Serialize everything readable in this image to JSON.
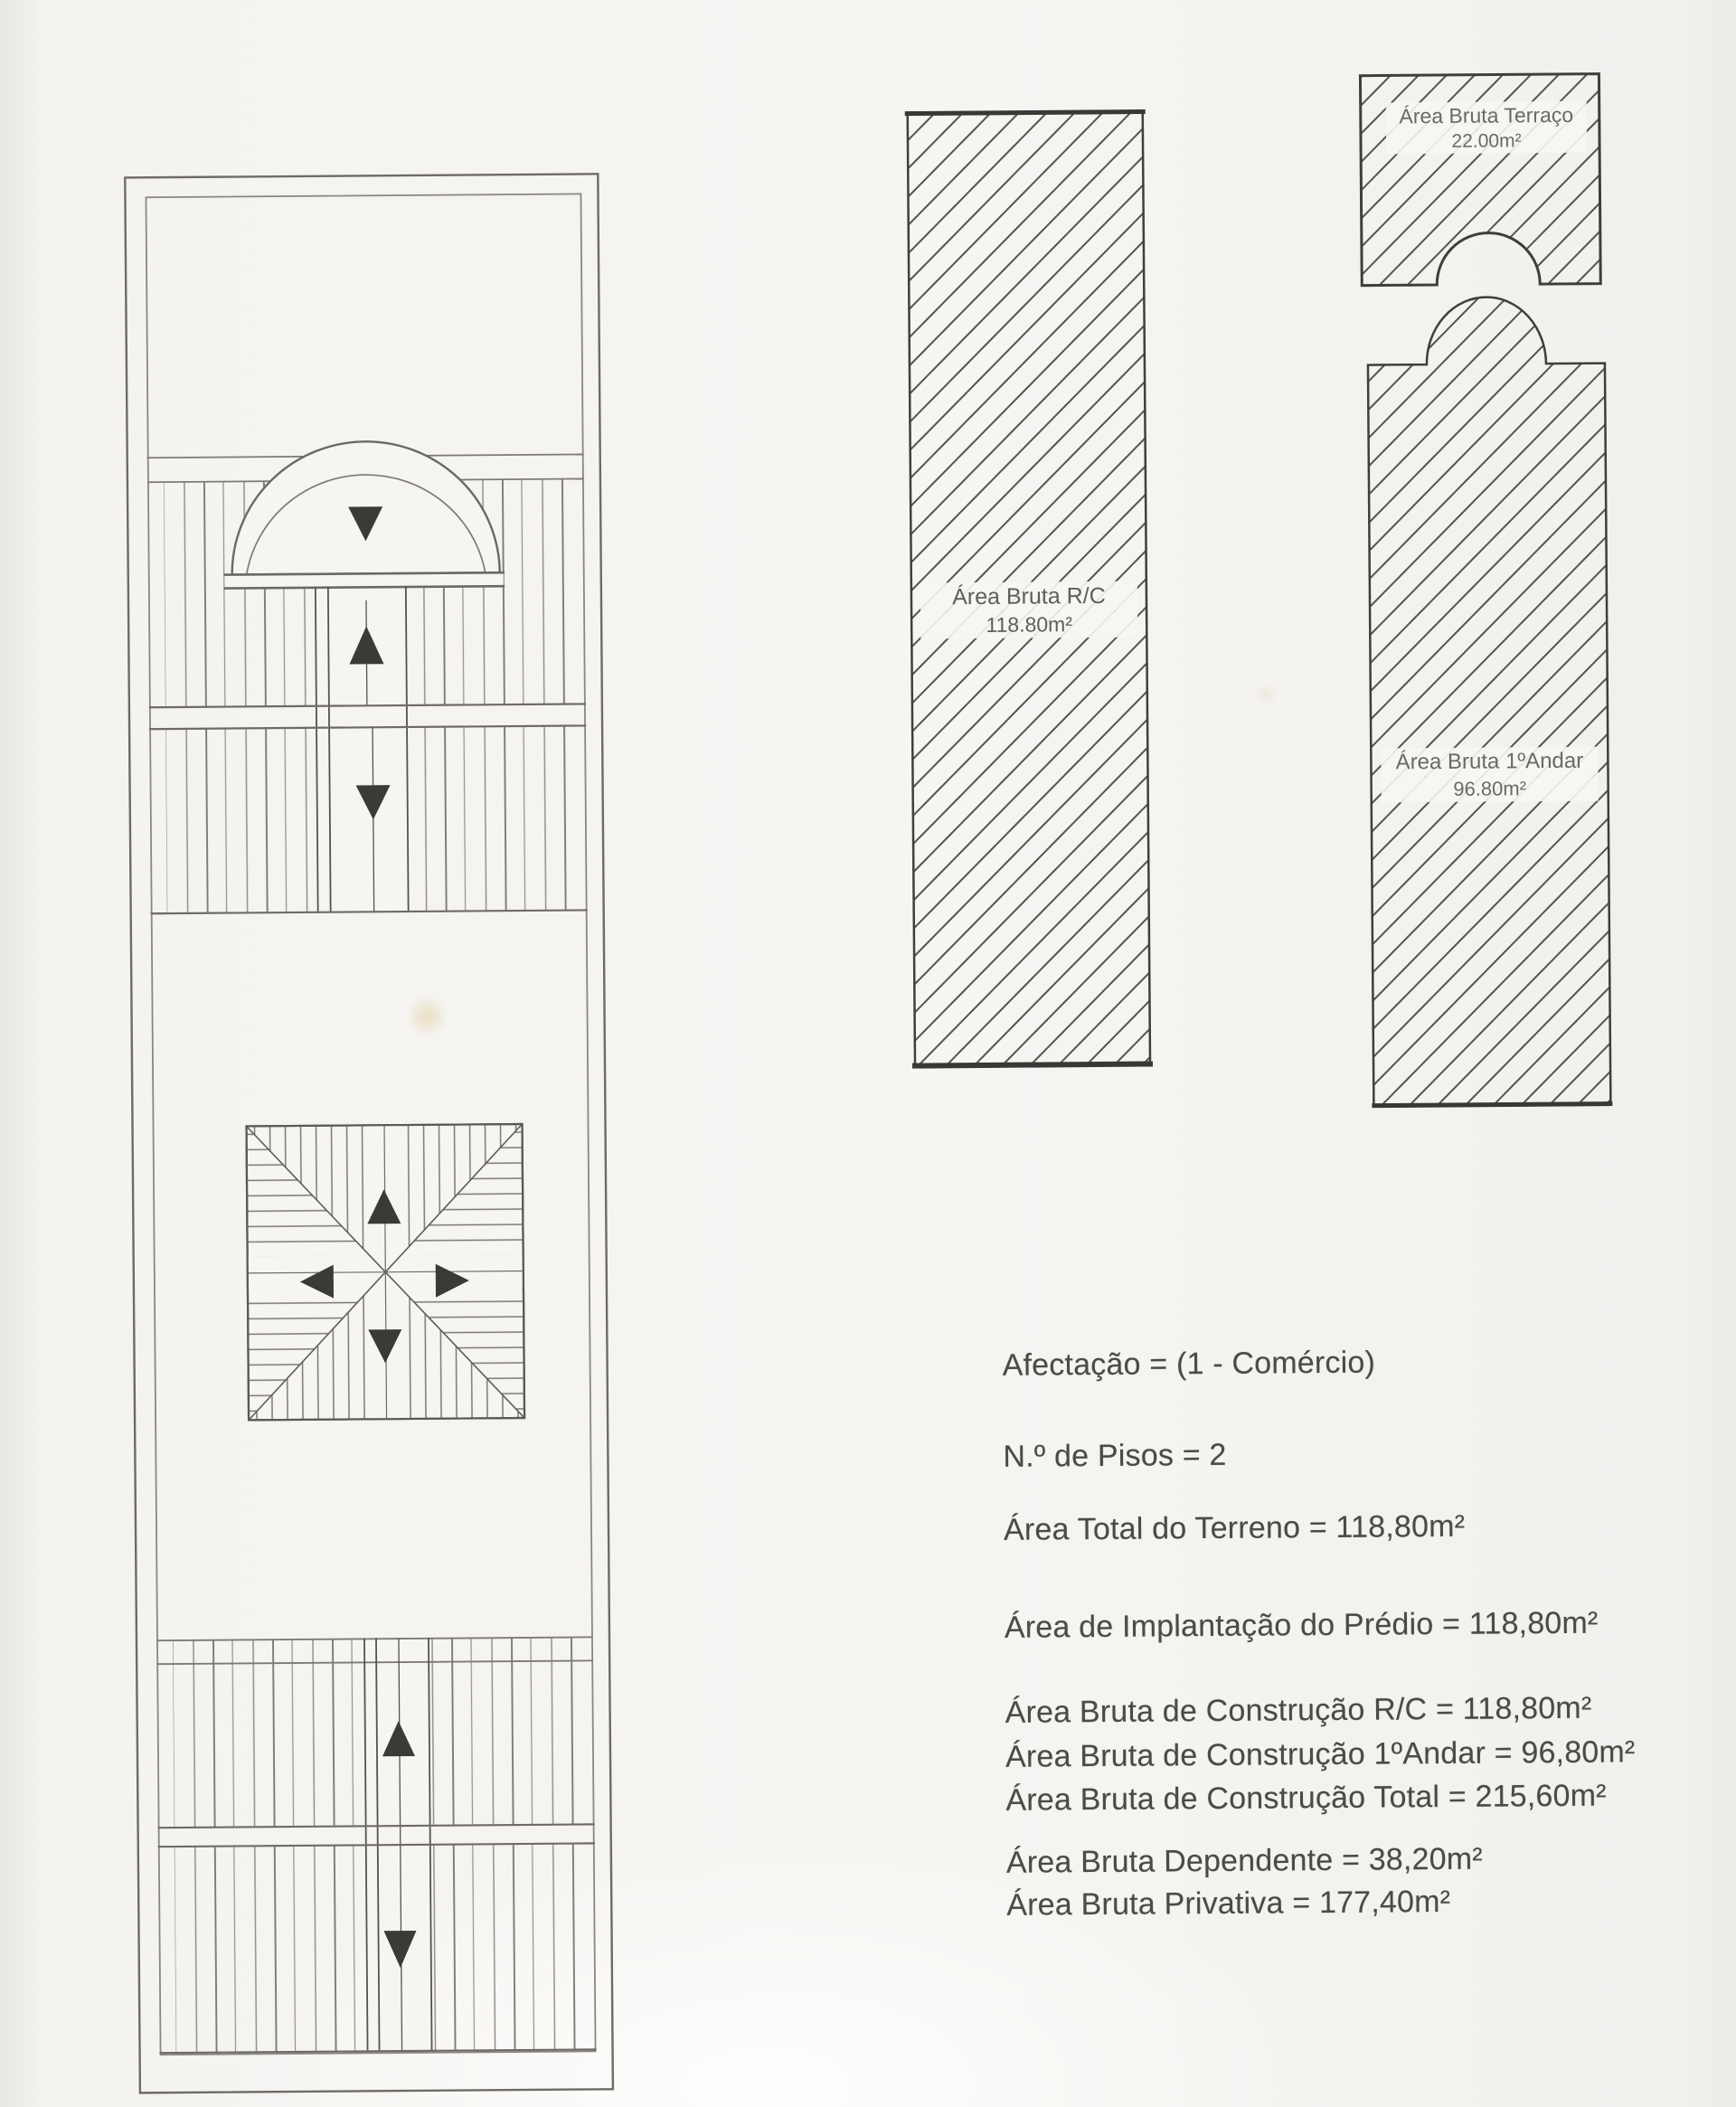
{
  "shapes": {
    "terraco": {
      "name": "Área Bruta Terraço",
      "area": "22.00m²"
    },
    "rc": {
      "name": "Área Bruta R/C",
      "area": "118.80m²"
    },
    "andar": {
      "name": "Área Bruta 1ºAndar",
      "area": "96.80m²"
    }
  },
  "info": {
    "lines": [
      "Afectação = (1 - Comércio)",
      "N.º de Pisos = 2",
      "Área Total do Terreno = 118,80m²",
      "Área de Implantação do Prédio = 118,80m²",
      "Área Bruta de Construção R/C = 118,80m²",
      "Área Bruta de Construção 1ºAndar = 96,80m²",
      "Área Bruta de Construção Total = 215,60m²",
      "Área Bruta Dependente = 38,20m²",
      "Área Bruta Privativa = 177,40m²"
    ]
  },
  "colors": {
    "paper": "#f5f4f1",
    "shape_border_ink": "#413f3c",
    "plan_line": "#6e6b66",
    "hatch_line": "#55534e",
    "arrow_triangle": "#3b3a37",
    "shape_label_text": "#6b6965",
    "info_text": "#4b4a47"
  }
}
